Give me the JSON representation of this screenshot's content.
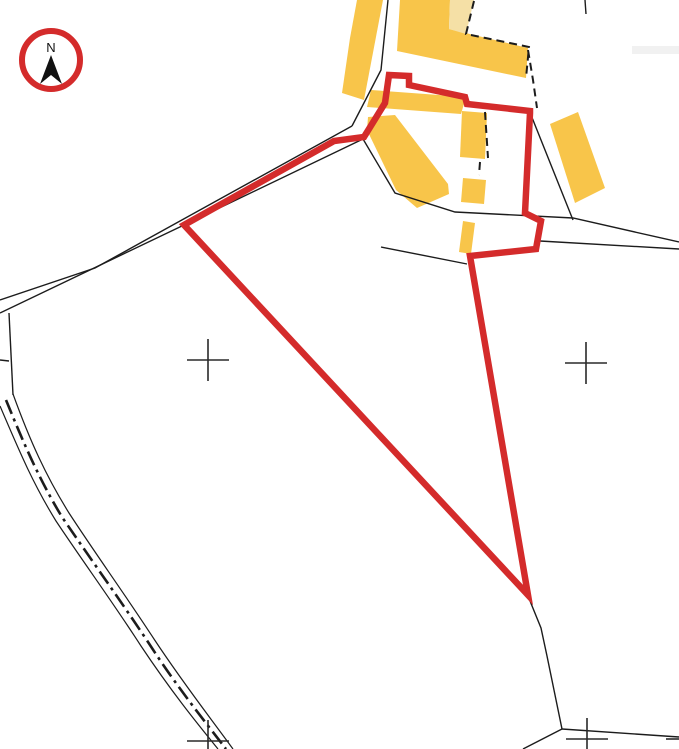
{
  "map": {
    "background": "#ffffff",
    "colors": {
      "building": "#F8C54A",
      "building_pale": "#F5E0A6",
      "boundary_red": "#D42B2B",
      "line": "#1c1c1c",
      "cross": "#2a2a2a",
      "artifact": "#e6e6e6"
    },
    "north_arrow": {
      "label": "N",
      "cx": 51,
      "cy": 60,
      "r": 29,
      "ring_width": 6,
      "pointer": "M51,55 L62,84 L51,75 L40,84 Z"
    },
    "buildings": [
      {
        "name": "barn-strip-west",
        "color": "building",
        "points": [
          [
            357,
            0
          ],
          [
            383,
            0
          ],
          [
            364,
            100
          ],
          [
            342,
            93
          ],
          [
            350,
            38
          ]
        ]
      },
      {
        "name": "barn-l-shaped",
        "color": "building",
        "points": [
          [
            400,
            0
          ],
          [
            450,
            0
          ],
          [
            449,
            29
          ],
          [
            528,
            48
          ],
          [
            526,
            78
          ],
          [
            397,
            51
          ]
        ]
      },
      {
        "name": "barn-l-shaped-pale-section",
        "color": "building_pale",
        "points": [
          [
            450,
            0
          ],
          [
            474,
            0
          ],
          [
            466,
            34
          ],
          [
            449,
            29
          ]
        ]
      },
      {
        "name": "building-upper-bar",
        "color": "building",
        "points": [
          [
            371,
            90
          ],
          [
            466,
            97
          ],
          [
            461,
            114
          ],
          [
            367,
            107
          ]
        ]
      },
      {
        "name": "barn-diagonal",
        "color": "building",
        "points": [
          [
            368,
            117
          ],
          [
            395,
            115
          ],
          [
            448,
            184
          ],
          [
            449,
            194
          ],
          [
            417,
            208
          ],
          [
            396,
            190
          ],
          [
            367,
            130
          ]
        ]
      },
      {
        "name": "building-tall-narrow",
        "color": "building",
        "points": [
          [
            462,
            111
          ],
          [
            487,
            113
          ],
          [
            485,
            159
          ],
          [
            460,
            157
          ]
        ]
      },
      {
        "name": "building-small-square",
        "color": "building",
        "points": [
          [
            463,
            178
          ],
          [
            486,
            180
          ],
          [
            484,
            204
          ],
          [
            461,
            202
          ]
        ]
      },
      {
        "name": "building-yard-small",
        "color": "building",
        "points": [
          [
            463,
            221
          ],
          [
            475,
            223
          ],
          [
            471,
            254
          ],
          [
            459,
            252
          ]
        ]
      },
      {
        "name": "barn-east-rotated",
        "color": "building",
        "points": [
          [
            578,
            112
          ],
          [
            605,
            188
          ],
          [
            575,
            203
          ],
          [
            550,
            124
          ]
        ]
      }
    ],
    "solid_lines": [
      {
        "name": "road-edge-upper",
        "points": [
          [
            352,
            126
          ],
          [
            95,
            268
          ],
          [
            0,
            300
          ]
        ]
      },
      {
        "name": "road-edge-lower",
        "points": [
          [
            363,
            139
          ],
          [
            184,
            225
          ],
          [
            0,
            313
          ]
        ]
      },
      {
        "name": "strip-parcel-line",
        "points": [
          [
            388,
            0
          ],
          [
            381,
            70
          ],
          [
            352,
            126
          ]
        ]
      },
      {
        "name": "farmyard-boundary",
        "points": [
          [
            363,
            139
          ],
          [
            395,
            193
          ],
          [
            455,
            212
          ],
          [
            573,
            218
          ],
          [
            679,
            242
          ]
        ]
      },
      {
        "name": "track-wedge-lower",
        "points": [
          [
            540,
            241
          ],
          [
            679,
            249
          ]
        ]
      },
      {
        "name": "farmyard-east-line",
        "points": [
          [
            531,
            115
          ],
          [
            573,
            220
          ]
        ]
      },
      {
        "name": "field-line-west",
        "points": [
          [
            381,
            247
          ],
          [
            467,
            264
          ]
        ]
      },
      {
        "name": "field-line-south",
        "points": [
          [
            528,
            596
          ],
          [
            541,
            628
          ],
          [
            547,
            656
          ],
          [
            562,
            729
          ]
        ]
      },
      {
        "name": "field-line-south-left",
        "points": [
          [
            562,
            729
          ],
          [
            523,
            749
          ]
        ]
      },
      {
        "name": "field-line-south-right",
        "points": [
          [
            562,
            729
          ],
          [
            679,
            737
          ]
        ]
      },
      {
        "name": "short-line-top",
        "points": [
          [
            585,
            0
          ],
          [
            586,
            14
          ]
        ]
      },
      {
        "name": "left-vertical-line",
        "points": [
          [
            9,
            313
          ],
          [
            13,
            395
          ]
        ]
      },
      {
        "name": "left-edge-tick",
        "points": [
          [
            0,
            360
          ],
          [
            9,
            361
          ]
        ]
      }
    ],
    "dashed_lines": [
      {
        "name": "dashed-outline-pale-section",
        "points": [
          [
            474,
            1
          ],
          [
            466,
            34
          ],
          [
            529,
            47
          ],
          [
            526,
            78
          ]
        ]
      },
      {
        "name": "dashed-parcel-continuation",
        "points": [
          [
            528,
            50
          ],
          [
            533,
            80
          ],
          [
            537,
            108
          ]
        ]
      },
      {
        "name": "dashed-edge-tall-building",
        "points": [
          [
            485,
            112
          ],
          [
            488,
            158
          ]
        ]
      },
      {
        "name": "dashed-gap-small",
        "points": [
          [
            480,
            162
          ],
          [
            479,
            175
          ]
        ]
      }
    ],
    "red_boundary": {
      "name": "application-site-boundary",
      "stroke_width": 6.5,
      "points": [
        [
          389,
          75
        ],
        [
          409,
          76
        ],
        [
          409,
          85
        ],
        [
          465,
          97
        ],
        [
          467,
          104
        ],
        [
          530,
          111
        ],
        [
          530,
          113
        ],
        [
          525,
          213
        ],
        [
          541,
          221
        ],
        [
          536,
          249
        ],
        [
          470,
          256
        ],
        [
          528,
          595
        ],
        [
          184,
          225
        ],
        [
          334,
          141
        ],
        [
          364,
          137
        ],
        [
          385,
          103
        ]
      ]
    },
    "track": {
      "name": "track-dash-dot",
      "edges": [
        "M 0,406 C 18,448 32,482 56,521 C 86,566 112,601 141,646 C 171,691 196,722 218,749",
        "M 13,394 C 30,441 46,476 69,513 C 97,556 124,593 154,639 C 183,683 209,716 233,749"
      ],
      "center": "M 6,400 C 24,444 39,479 62,517 C 92,561 118,597 148,642 C 177,687 203,719 226,749",
      "center_dash": "15 5 3 5",
      "center_width": 2.6
    },
    "grid_crosses": {
      "centers": [
        [
          208,
          360
        ],
        [
          586,
          363
        ],
        [
          208,
          741
        ],
        [
          587,
          739
        ]
      ],
      "arm": 21,
      "partial_arms": [
        [
          [
            666,
            739
          ],
          [
            679,
            739
          ]
        ]
      ]
    },
    "artifact": {
      "x": 632,
      "y": 46,
      "w": 47,
      "h": 8
    }
  }
}
